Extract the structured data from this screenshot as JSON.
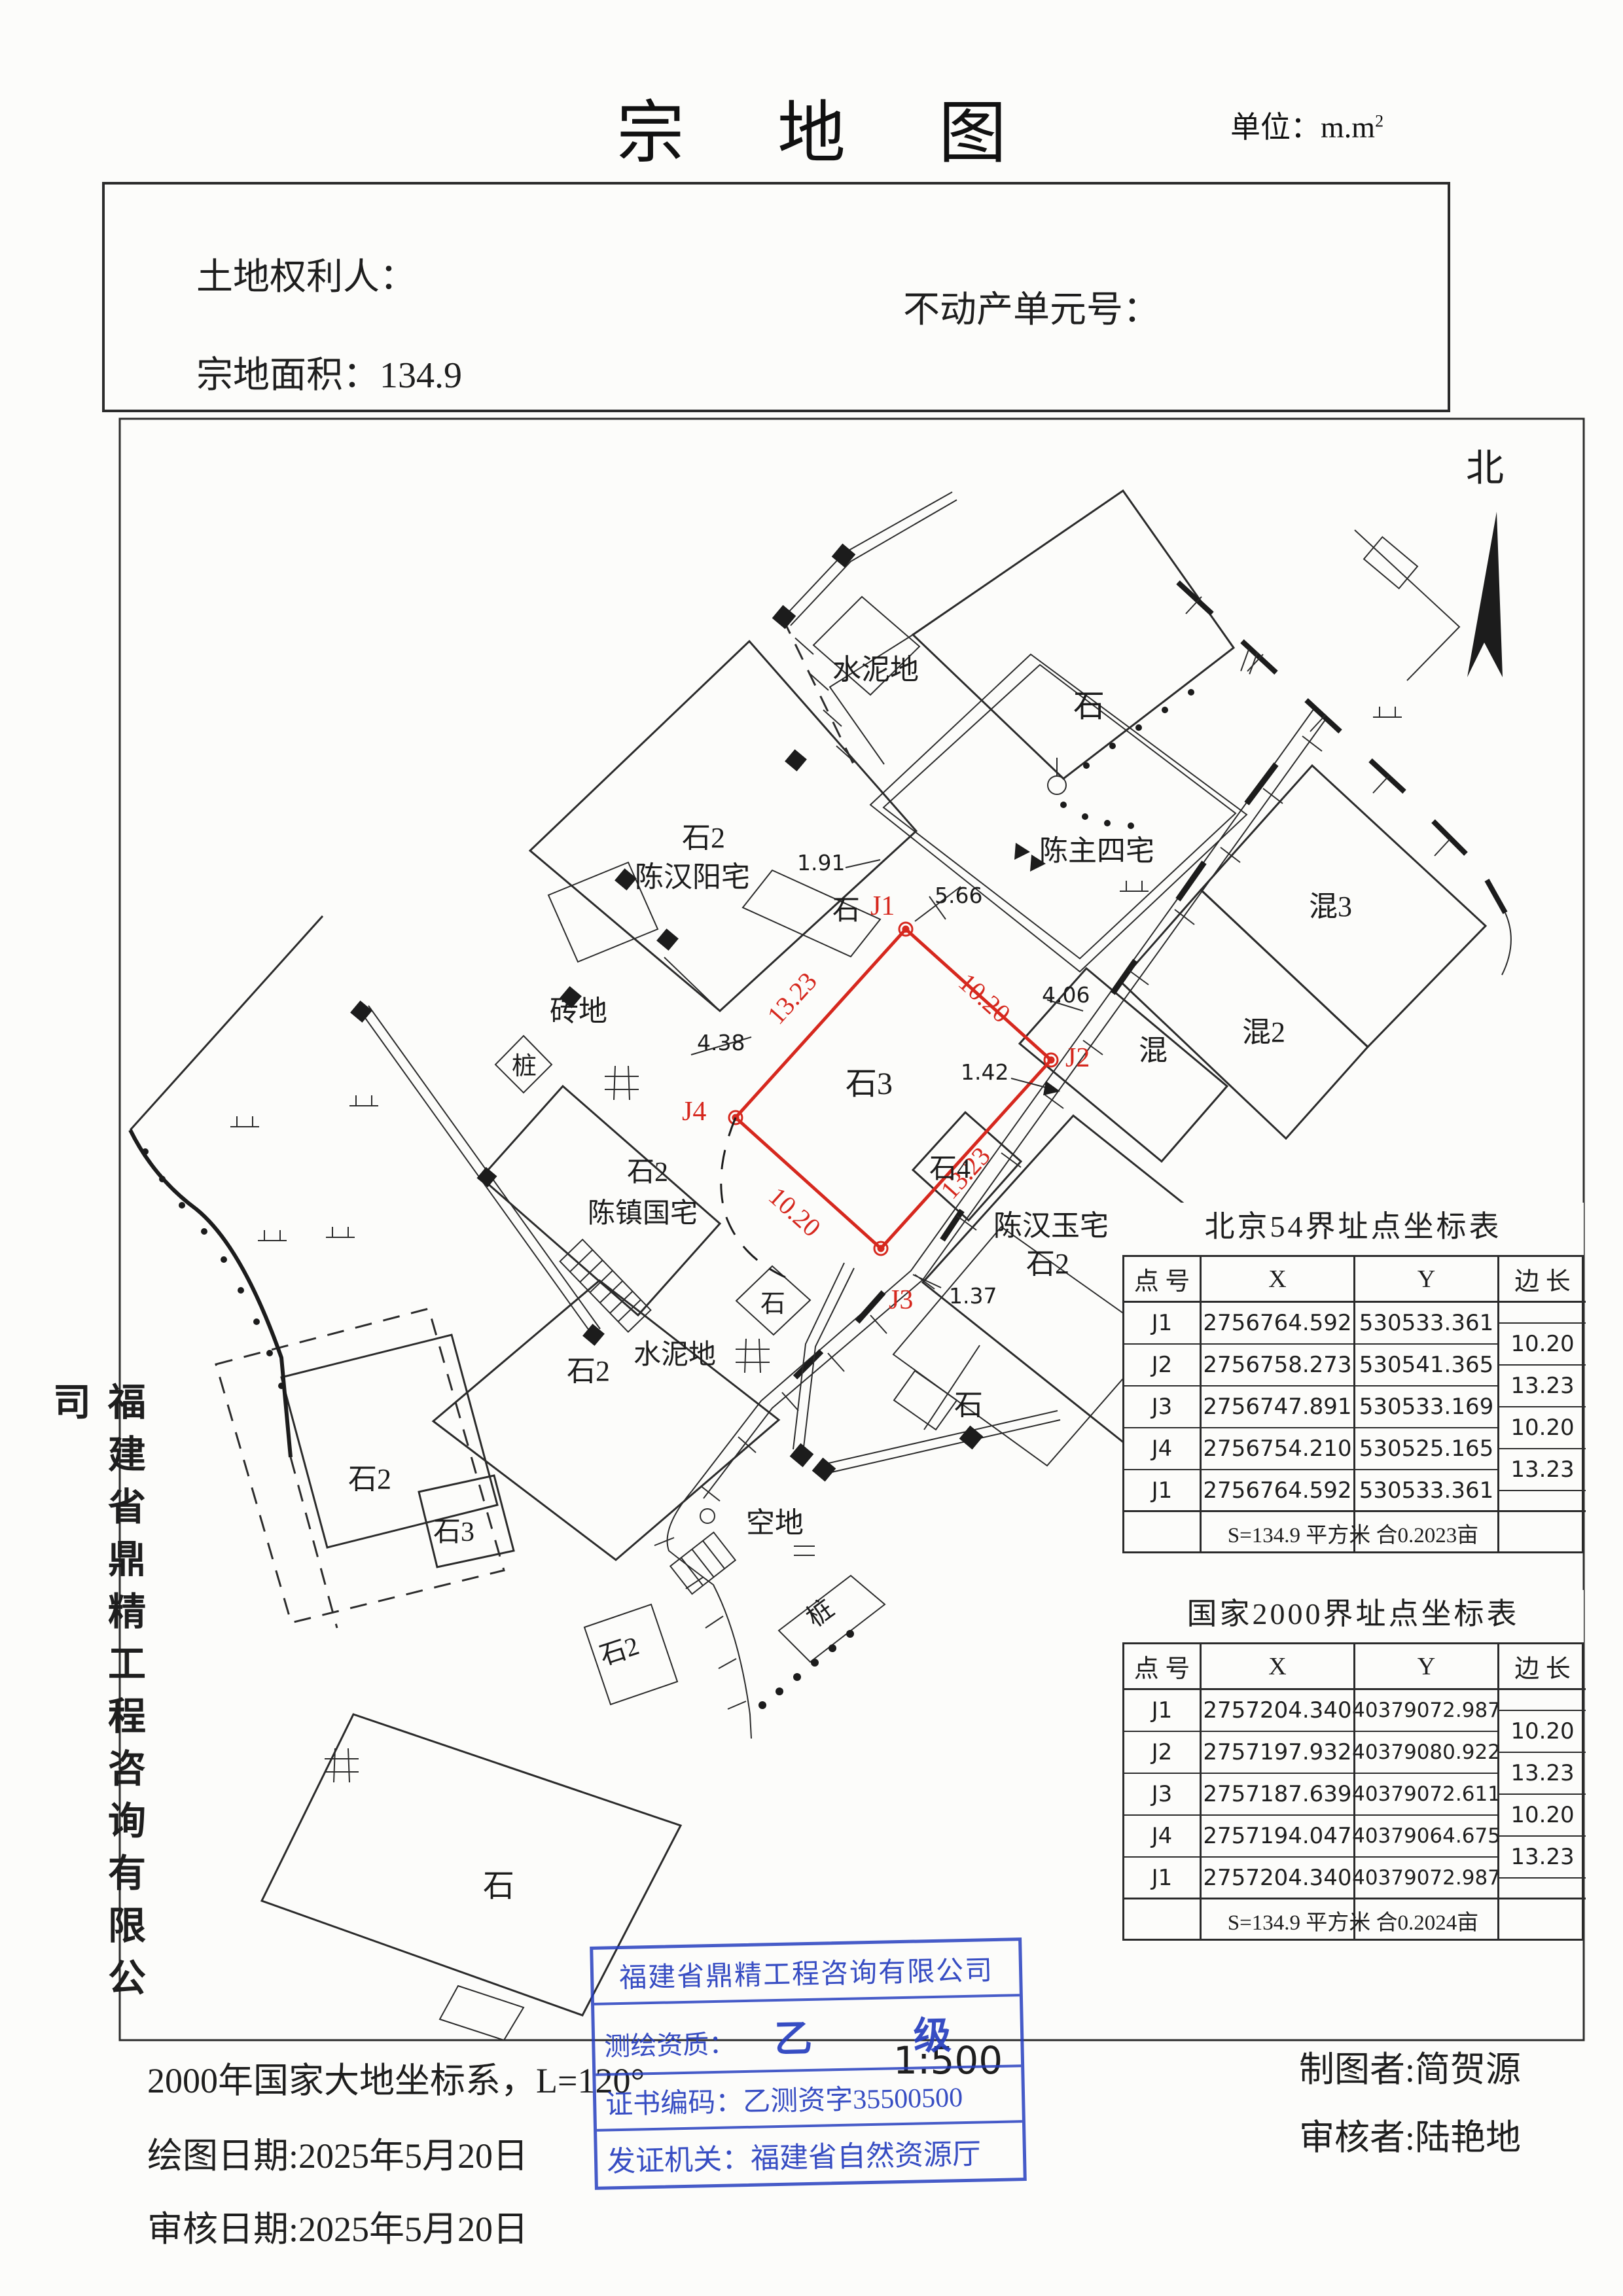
{
  "page": {
    "title": "宗 地 图",
    "unit_label": "单位：m.m",
    "unit_sup": "2"
  },
  "header": {
    "land_owner_label": "土地权利人：",
    "unit_no_label": "不动产单元号：",
    "area_label": "宗地面积：134.9"
  },
  "sidebar_company": "福建省鼎精工程咨询有限公司",
  "map": {
    "north_label": "北",
    "parcel_points": [
      "J1",
      "J2",
      "J3",
      "J4"
    ],
    "labels": {
      "shi_top": "石",
      "shuinidi_a": "水泥地",
      "chenzhusizhai": "陈主四宅",
      "shi2_a": "石2",
      "chenhanyang": "陈汉阳宅",
      "m191": "1.91",
      "shi_strip": "石",
      "m566": "5.66",
      "hun3": "混3",
      "m406": "4.06",
      "zhuandi": "砖地",
      "hun": "混",
      "hun2": "混2",
      "zhuang_a": "桩",
      "m438": "4.38",
      "shi3_parcel": "石3",
      "m142": "1.42",
      "shi4": "石4",
      "shi2_b": "石2",
      "chenzhenguo": "陈镇国宅",
      "chenhanyu": "陈汉玉宅",
      "shi2_yu": "石2",
      "m137": "1.37",
      "shuinidi_b": "水泥地",
      "shi_e": "石",
      "shi_f": "石",
      "shi2_c": "石2",
      "shi2_d": "石2",
      "shi3_b": "石3",
      "kongdi": "空地",
      "zhuang_b": "桩",
      "shi2_e": "石2",
      "shi_d": "石",
      "j1": "J1",
      "j2": "J2",
      "j3": "J3",
      "j4": "J4",
      "e1": "10.20",
      "e2": "13.23",
      "e3": "10.20",
      "e4": "13.23"
    }
  },
  "tables": [
    {
      "title": "北京54界址点坐标表",
      "headers": [
        "点 号",
        "X",
        "Y",
        "边 长"
      ],
      "rows": [
        [
          "J1",
          "2756764.592",
          "530533.361"
        ],
        [
          "J2",
          "2756758.273",
          "530541.365"
        ],
        [
          "J3",
          "2756747.891",
          "530533.169"
        ],
        [
          "J4",
          "2756754.210",
          "530525.165"
        ],
        [
          "J1",
          "2756764.592",
          "530533.361"
        ]
      ],
      "edges": [
        "10.20",
        "13.23",
        "10.20",
        "13.23"
      ],
      "summary": "S=134.9 平方米  合0.2023亩"
    },
    {
      "title": "国家2000界址点坐标表",
      "headers": [
        "点 号",
        "X",
        "Y",
        "边 长"
      ],
      "rows": [
        [
          "J1",
          "2757204.340",
          "40379072.987"
        ],
        [
          "J2",
          "2757197.932",
          "40379080.922"
        ],
        [
          "J3",
          "2757187.639",
          "40379072.611"
        ],
        [
          "J4",
          "2757194.047",
          "40379064.675"
        ],
        [
          "J1",
          "2757204.340",
          "40379072.987"
        ]
      ],
      "edges": [
        "10.20",
        "13.23",
        "10.20",
        "13.23"
      ],
      "summary": "S=134.9 平方米  合0.2024亩"
    }
  ],
  "stamp": {
    "company": "福建省鼎精工程咨询有限公司",
    "qual_label": "测绘资质：",
    "qual_value": "乙  级",
    "cert_line": "证书编码：乙测资字35500500",
    "issuer_line": "发证机关：福建省自然资源厅"
  },
  "scale_text": "1:500",
  "footer": {
    "coord_system": "2000年国家大地坐标系，L=120°",
    "draw_date": "绘图日期:2025年5月20日",
    "review_date": "审核日期:2025年5月20日",
    "drafter": "制图者:简贺源",
    "reviewer": "审核者:陆艳地"
  }
}
